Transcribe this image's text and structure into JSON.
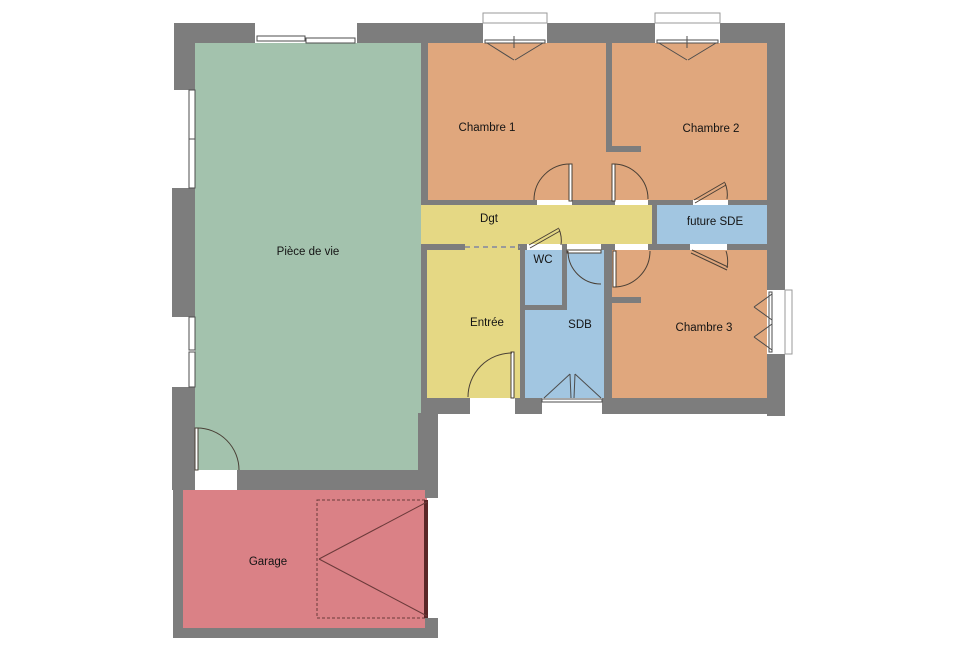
{
  "plan": {
    "canvas": {
      "w": 960,
      "h": 665
    },
    "background": "#ffffff",
    "colors": {
      "wall": "#7d7d7d",
      "living": "#a3c2ad",
      "bedroom": "#e0a77d",
      "hall": "#e5d884",
      "wet": "#a2c6e1",
      "garage": "#da8186",
      "line": "#4a4036",
      "window_line": "#4d4d4d",
      "garage_line": "#6b3a3a",
      "text": "#141414"
    },
    "rooms": [
      {
        "id": "piece-de-vie",
        "label": "Pièce de vie",
        "color": "living",
        "rects": [
          [
            195,
            43,
            226,
            427
          ]
        ],
        "label_pos": [
          308,
          251
        ]
      },
      {
        "id": "chambre-1",
        "label": "Chambre 1",
        "color": "bedroom",
        "rects": [
          [
            428,
            43,
            178,
            157
          ]
        ],
        "label_pos": [
          487,
          127
        ]
      },
      {
        "id": "chambre-2",
        "label": "Chambre 2",
        "color": "bedroom",
        "rects": [
          [
            612,
            43,
            155,
            157
          ],
          [
            606,
            152,
            6,
            48
          ]
        ],
        "label_pos": [
          711,
          128
        ]
      },
      {
        "id": "dgt",
        "label": "Dgt",
        "color": "hall",
        "rects": [
          [
            421,
            205,
            231,
            39
          ]
        ],
        "label_pos": [
          489,
          218
        ]
      },
      {
        "id": "future-sde",
        "label": "future SDE",
        "color": "wet",
        "rects": [
          [
            657,
            205,
            110,
            39
          ]
        ],
        "label_pos": [
          715,
          221
        ]
      },
      {
        "id": "entree",
        "label": "Entrée",
        "color": "hall",
        "rects": [
          [
            427,
            244,
            93,
            154
          ]
        ],
        "label_pos": [
          487,
          322
        ]
      },
      {
        "id": "wc",
        "label": "WC",
        "color": "wet",
        "rects": [
          [
            525,
            250,
            37,
            55
          ]
        ],
        "label_pos": [
          543,
          259
        ]
      },
      {
        "id": "sdb",
        "label": "SDB",
        "color": "wet",
        "rects": [
          [
            567,
            250,
            37,
            148
          ],
          [
            525,
            310,
            42,
            88
          ]
        ],
        "label_pos": [
          580,
          324
        ]
      },
      {
        "id": "chambre-3",
        "label": "Chambre 3",
        "color": "bedroom",
        "rects": [
          [
            612,
            250,
            155,
            148
          ]
        ],
        "label_pos": [
          704,
          327
        ]
      },
      {
        "id": "garage",
        "label": "Garage",
        "color": "garage",
        "rects": [
          [
            183,
            490,
            244,
            138
          ]
        ],
        "label_pos": [
          268,
          561
        ]
      }
    ],
    "walls": [
      [
        174,
        23,
        81,
        20
      ],
      [
        357,
        23,
        126,
        20
      ],
      [
        547,
        23,
        108,
        20
      ],
      [
        720,
        23,
        65,
        20
      ],
      [
        174,
        23,
        21,
        67
      ],
      [
        172,
        188,
        23,
        129
      ],
      [
        172,
        387,
        23,
        103
      ],
      [
        767,
        23,
        18,
        267
      ],
      [
        767,
        354,
        18,
        62
      ],
      [
        421,
        43,
        7,
        162
      ],
      [
        421,
        244,
        6,
        169
      ],
      [
        428,
        200,
        109,
        5
      ],
      [
        572,
        200,
        34,
        5
      ],
      [
        606,
        200,
        9,
        5
      ],
      [
        648,
        200,
        45,
        5
      ],
      [
        728,
        200,
        39,
        5
      ],
      [
        606,
        43,
        6,
        109
      ],
      [
        612,
        146,
        29,
        6
      ],
      [
        652,
        205,
        5,
        39
      ],
      [
        421,
        244,
        44,
        6
      ],
      [
        518,
        244,
        9,
        6
      ],
      [
        562,
        244,
        5,
        6
      ],
      [
        601,
        244,
        14,
        6
      ],
      [
        648,
        244,
        42,
        6
      ],
      [
        727,
        244,
        40,
        6
      ],
      [
        520,
        244,
        5,
        169
      ],
      [
        562,
        250,
        5,
        60
      ],
      [
        525,
        305,
        42,
        5
      ],
      [
        604,
        250,
        8,
        148
      ],
      [
        612,
        297,
        29,
        6
      ],
      [
        421,
        398,
        49,
        16
      ],
      [
        515,
        398,
        27,
        16
      ],
      [
        602,
        398,
        183,
        16
      ],
      [
        418,
        413,
        20,
        57
      ],
      [
        237,
        470,
        201,
        20
      ],
      [
        173,
        490,
        10,
        138
      ],
      [
        173,
        628,
        265,
        10
      ],
      [
        425,
        490,
        13,
        8
      ],
      [
        425,
        618,
        13,
        10
      ]
    ],
    "windows": [
      {
        "name": "bay-window-living",
        "frames": [
          [
            257,
            36,
            48,
            5
          ],
          [
            306,
            38,
            49,
            5
          ]
        ]
      },
      {
        "name": "window-chambre1",
        "boxes": [
          [
            483,
            13,
            64,
            10
          ]
        ],
        "frames": [
          [
            485,
            40,
            60,
            3
          ]
        ],
        "lines": [
          [
            487,
            43,
            514,
            60
          ],
          [
            543,
            43,
            515,
            60
          ],
          [
            514,
            36,
            514,
            48
          ]
        ]
      },
      {
        "name": "window-chambre2",
        "boxes": [
          [
            655,
            13,
            65,
            10
          ]
        ],
        "frames": [
          [
            657,
            40,
            61,
            3
          ]
        ],
        "lines": [
          [
            659,
            43,
            687,
            60
          ],
          [
            716,
            43,
            688,
            60
          ],
          [
            687,
            36,
            687,
            48
          ]
        ]
      },
      {
        "name": "window-chambre3",
        "boxes": [
          [
            785,
            290,
            7,
            64
          ]
        ],
        "frames": [
          [
            769,
            292,
            3,
            60
          ]
        ],
        "lines": [
          [
            772,
            294,
            754,
            307
          ],
          [
            772,
            320,
            754,
            307
          ],
          [
            772,
            324,
            754,
            337
          ],
          [
            772,
            350,
            754,
            337
          ]
        ]
      },
      {
        "name": "window-sdb",
        "frames": [
          [
            542,
            399,
            60,
            3
          ]
        ],
        "lines": [
          [
            544,
            398,
            570,
            374
          ],
          [
            570,
            374,
            571,
            398
          ],
          [
            601,
            398,
            575,
            374
          ],
          [
            575,
            374,
            574,
            398
          ]
        ]
      },
      {
        "name": "window-living-left-1",
        "frames": [
          [
            189,
            90,
            6,
            98
          ]
        ],
        "lines": [
          [
            189,
            139,
            195,
            139
          ]
        ]
      },
      {
        "name": "window-living-left-2",
        "frames": [
          [
            189,
            317,
            6,
            33
          ],
          [
            189,
            352,
            6,
            35
          ]
        ]
      }
    ],
    "doors": [
      {
        "name": "living-garage-door",
        "leaf": [
          195,
          428,
          3,
          42
        ],
        "arc": "M197,428 A42,42 0 0 1 239,470"
      },
      {
        "name": "entry-door",
        "leaf": [
          511,
          352,
          3,
          46
        ],
        "arc": "M512,353 A44,44 0 0 0 468,397"
      },
      {
        "name": "chambre1-door",
        "leaf": [
          569,
          164,
          3,
          37
        ],
        "arc": "M570,164 A36,36 0 0 0 534,200"
      },
      {
        "name": "chambre2-door",
        "leaf": [
          612,
          164,
          3,
          37
        ],
        "arc": "M613,164 A35,35 0 0 1 648,199"
      },
      {
        "name": "chambre3-door",
        "leaf": [
          613,
          251,
          3,
          36
        ],
        "arc": "M614,287 A36,36 0 0 0 650,251"
      },
      {
        "name": "sdb-door",
        "leaf": [
          567,
          250,
          34,
          3
        ],
        "arc": "M568,251 A33,33 0 0 0 601,284"
      },
      {
        "name": "wc-door",
        "lines": [
          [
            529,
            245,
            559,
            228
          ],
          [
            530,
            248,
            560,
            231
          ]
        ],
        "arc": "M559,229 A30,30 0 0 1 561,245"
      },
      {
        "name": "sde-door-chambre2",
        "lines": [
          [
            694,
            200,
            725,
            182
          ],
          [
            695,
            203,
            726,
            185
          ]
        ],
        "arc": "M725,183 A30,30 0 0 1 727,199"
      },
      {
        "name": "sde-door-chambre3",
        "lines": [
          [
            692,
            250,
            728,
            267
          ],
          [
            691,
            253,
            727,
            270
          ]
        ],
        "arc": "M727,268 A33,33 0 0 0 726,251"
      }
    ],
    "garage_door": {
      "dashed_rect": [
        317,
        500,
        110,
        118
      ],
      "panel": [
        424,
        500,
        4,
        118
      ],
      "lines": [
        [
          427,
          502,
          319,
          559
        ],
        [
          427,
          616,
          319,
          559
        ]
      ]
    },
    "open_boundary": {
      "line": [
        465,
        247,
        520,
        247
      ]
    }
  }
}
